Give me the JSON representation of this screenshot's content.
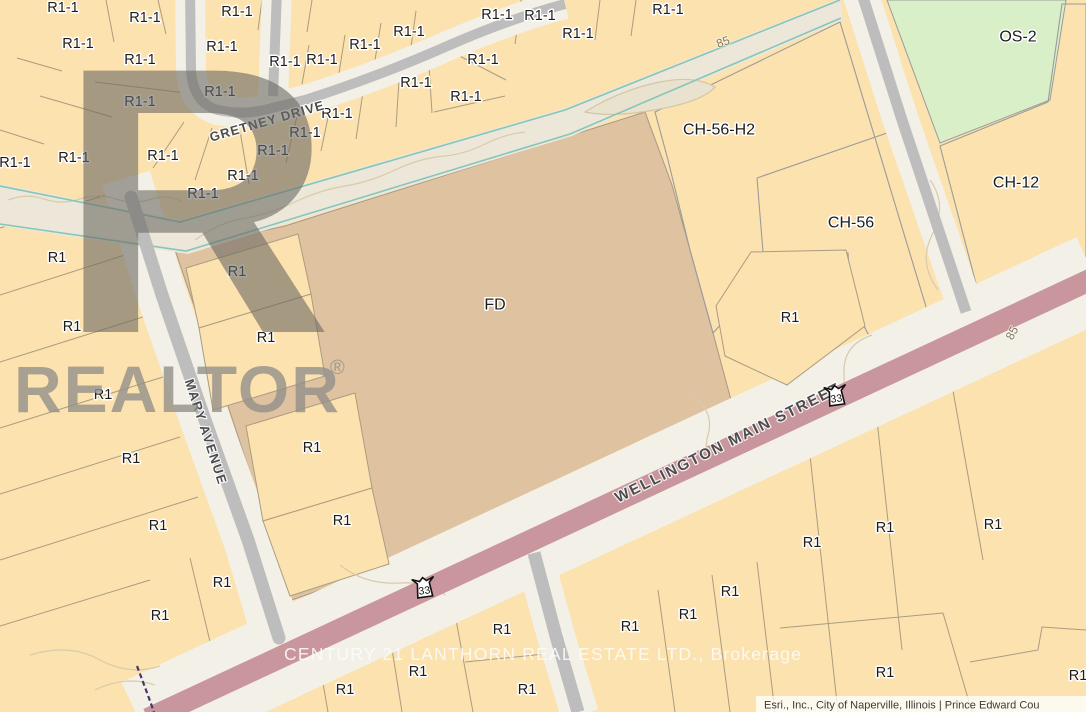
{
  "map": {
    "brand_watermark": {
      "logo_letter": "R",
      "name": "REALTOR",
      "reg": "®"
    },
    "listing_watermark": "CENTURY 21 LANTHORN REAL ESTATE LTD., Brokerage",
    "attribution": "Esri., Inc., City of Naperville, Illinois | Prince Edward Cou",
    "route_shields": [
      {
        "label": "33",
        "x": 836,
        "y": 396,
        "rot": -8
      },
      {
        "label": "33",
        "x": 424,
        "y": 588,
        "rot": -8
      }
    ],
    "street_labels": [
      {
        "text": "GRETNEY DRIVE",
        "x": 267,
        "y": 121,
        "rot": -16,
        "size": 13,
        "ls": 1
      },
      {
        "text": "MARY AVENUE",
        "x": 206,
        "y": 432,
        "rot": 72,
        "size": 13,
        "ls": 1.5
      },
      {
        "text": "WELLINGTON MAIN STREET",
        "x": 728,
        "y": 443,
        "rot": -26.5,
        "size": 15,
        "ls": 2
      }
    ],
    "zone_labels": [
      {
        "text": "FD",
        "x": 495,
        "y": 305
      },
      {
        "text": "CH-56-H2",
        "x": 719,
        "y": 130
      },
      {
        "text": "CH-56",
        "x": 851,
        "y": 223
      },
      {
        "text": "CH-12",
        "x": 1016,
        "y": 183
      },
      {
        "text": "OS-2",
        "x": 1018,
        "y": 37
      }
    ],
    "contour_labels": [
      {
        "text": "85",
        "x": 723,
        "y": 42,
        "rot": -20
      },
      {
        "text": "85",
        "x": 1012,
        "y": 333,
        "rot": -62
      }
    ],
    "parcel_labels": [
      {
        "text": "R1-1",
        "x": 63,
        "y": 8
      },
      {
        "text": "R1-1",
        "x": 78,
        "y": 44
      },
      {
        "text": "R1-1",
        "x": 145,
        "y": 18
      },
      {
        "text": "R1-1",
        "x": 237,
        "y": 12
      },
      {
        "text": "R1-1",
        "x": 140,
        "y": 60
      },
      {
        "text": "R1-1",
        "x": 222,
        "y": 47
      },
      {
        "text": "R1-1",
        "x": 220,
        "y": 92
      },
      {
        "text": "R1-1",
        "x": 140,
        "y": 102
      },
      {
        "text": "R1-1",
        "x": 163,
        "y": 156
      },
      {
        "text": "R1-1",
        "x": 74,
        "y": 158
      },
      {
        "text": "R1-1",
        "x": 15,
        "y": 163
      },
      {
        "text": "R1-1",
        "x": 285,
        "y": 62
      },
      {
        "text": "R1-1",
        "x": 322,
        "y": 60
      },
      {
        "text": "R1-1",
        "x": 365,
        "y": 45
      },
      {
        "text": "R1-1",
        "x": 409,
        "y": 32
      },
      {
        "text": "R1-1",
        "x": 497,
        "y": 15
      },
      {
        "text": "R1-1",
        "x": 483,
        "y": 60
      },
      {
        "text": "R1-1",
        "x": 416,
        "y": 83
      },
      {
        "text": "R1-1",
        "x": 466,
        "y": 97
      },
      {
        "text": "R1-1",
        "x": 337,
        "y": 114
      },
      {
        "text": "R1-1",
        "x": 305,
        "y": 133
      },
      {
        "text": "R1-1",
        "x": 273,
        "y": 151
      },
      {
        "text": "R1-1",
        "x": 243,
        "y": 176
      },
      {
        "text": "R1-1",
        "x": 203,
        "y": 194
      },
      {
        "text": "R1-1",
        "x": 540,
        "y": 16
      },
      {
        "text": "R1-1",
        "x": 578,
        "y": 34
      },
      {
        "text": "R1-1",
        "x": 668,
        "y": 10
      },
      {
        "text": "R1",
        "x": 57,
        "y": 258
      },
      {
        "text": "R1",
        "x": 72,
        "y": 327
      },
      {
        "text": "R1",
        "x": 103,
        "y": 395
      },
      {
        "text": "R1",
        "x": 131,
        "y": 459
      },
      {
        "text": "R1",
        "x": 158,
        "y": 526
      },
      {
        "text": "R1",
        "x": 222,
        "y": 583
      },
      {
        "text": "R1",
        "x": 160,
        "y": 616
      },
      {
        "text": "R1",
        "x": 237,
        "y": 272
      },
      {
        "text": "R1",
        "x": 266,
        "y": 338
      },
      {
        "text": "R1",
        "x": 312,
        "y": 448
      },
      {
        "text": "R1",
        "x": 342,
        "y": 521
      },
      {
        "text": "R1",
        "x": 790,
        "y": 318
      },
      {
        "text": "R1",
        "x": 812,
        "y": 543
      },
      {
        "text": "R1",
        "x": 885,
        "y": 528
      },
      {
        "text": "R1",
        "x": 993,
        "y": 525
      },
      {
        "text": "R1",
        "x": 885,
        "y": 673
      },
      {
        "text": "R1",
        "x": 1078,
        "y": 676
      },
      {
        "text": "R1",
        "x": 502,
        "y": 630
      },
      {
        "text": "R1",
        "x": 527,
        "y": 690
      },
      {
        "text": "R1",
        "x": 630,
        "y": 627
      },
      {
        "text": "R1",
        "x": 688,
        "y": 615
      },
      {
        "text": "R1",
        "x": 730,
        "y": 592
      },
      {
        "text": "R1",
        "x": 345,
        "y": 690
      },
      {
        "text": "R1",
        "x": 418,
        "y": 672
      }
    ],
    "colors": {
      "parcel_tan": "#fbe2ae",
      "fd_brown": "#dfc3a0",
      "road_gray": "#bdbdbd",
      "road_corridor": "#f3f0e7",
      "main_street_pink": "#c9969d",
      "hatch_pink": "#e7b0ae",
      "open_space_green": "#d9efc8",
      "stream_teal": "#85c6bc"
    }
  }
}
